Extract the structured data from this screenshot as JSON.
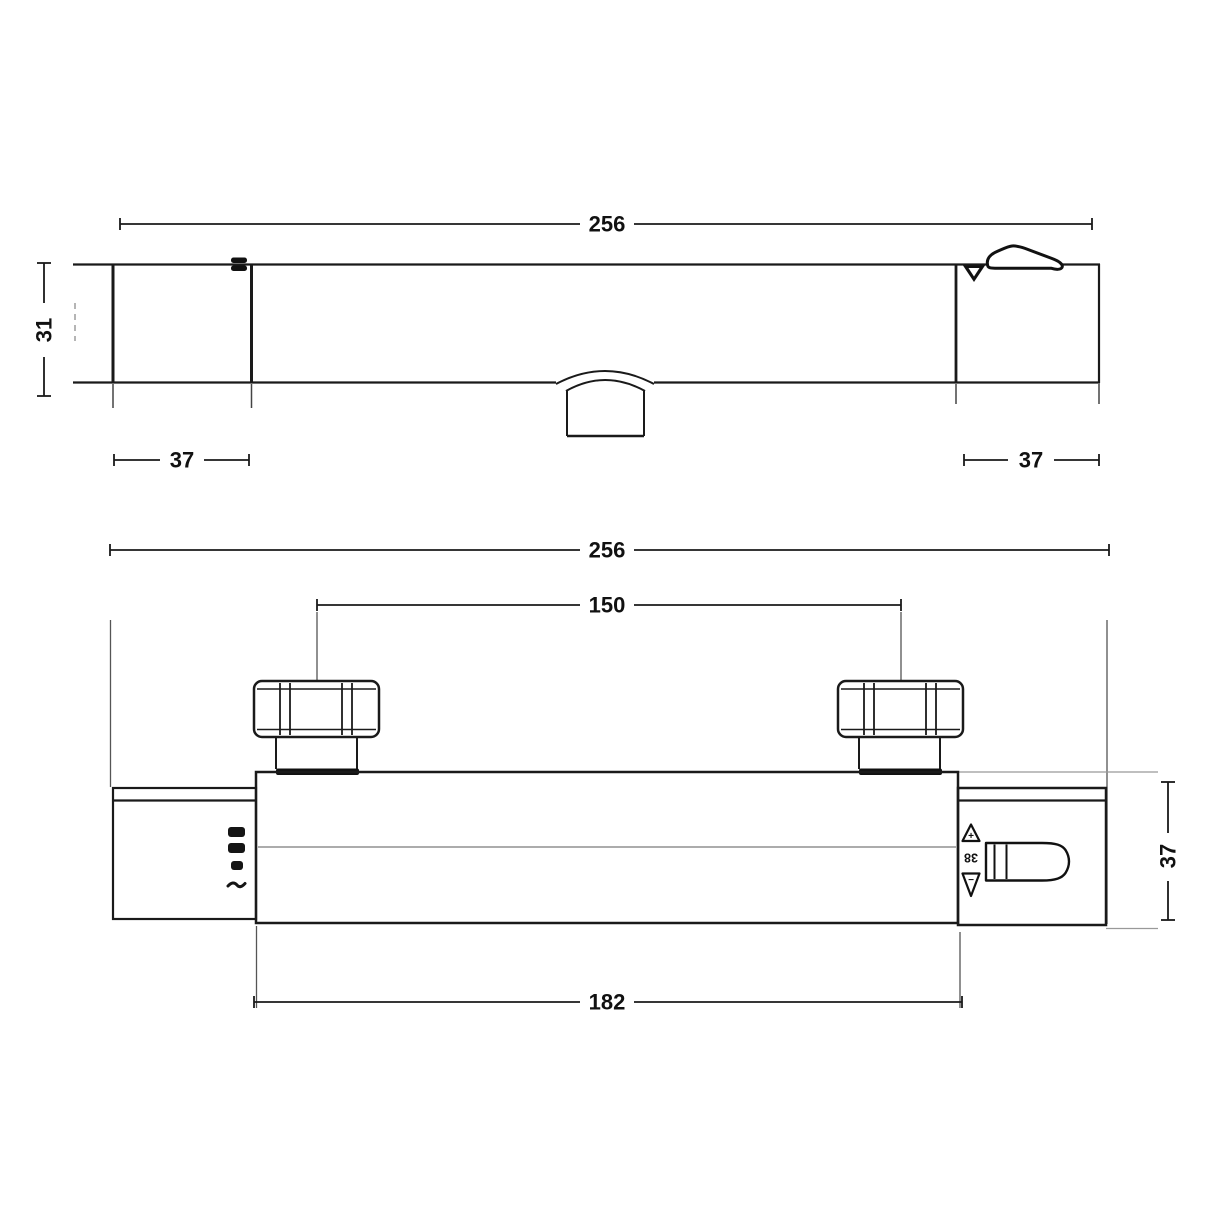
{
  "drawing": {
    "type": "technical-dimension-drawing",
    "subject": "thermostatic bar shower valve, two orthographic views",
    "top_view": {
      "overall_length": "256",
      "depth": "31",
      "left_end_length": "37",
      "right_end_length": "37"
    },
    "front_view": {
      "overall_length": "256",
      "inlet_centres": "150",
      "body_length": "182",
      "end_cap_height": "37",
      "temperature_stop": "38",
      "hotter_symbol": "+",
      "colder_symbol": "−"
    },
    "colors": {
      "line": "#1a1a1a",
      "thin_extension_line": "#8a8a8a",
      "background": "#ffffff",
      "text": "#111111"
    }
  }
}
